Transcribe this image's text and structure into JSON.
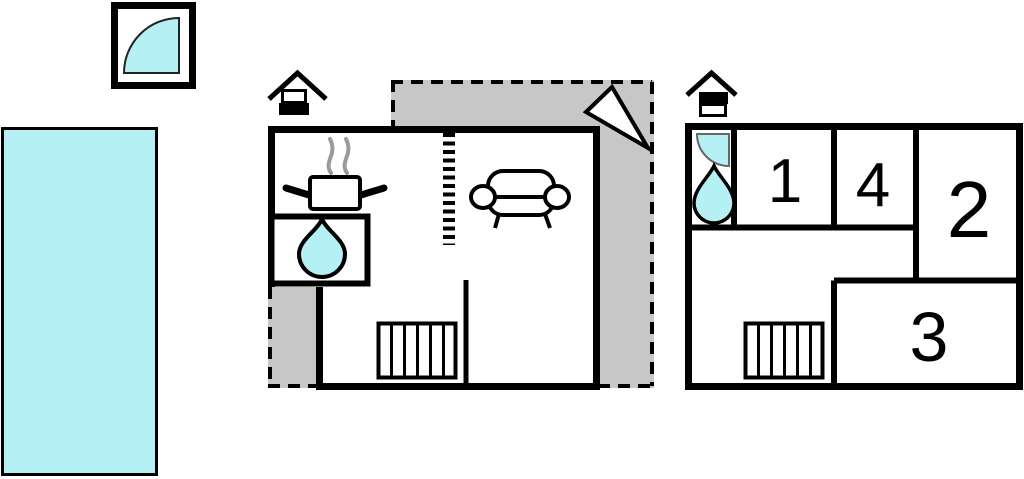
{
  "colors": {
    "water": "#b5f1f4",
    "terrace": "#c7c7c7",
    "wall": "#000000",
    "steam": "#9a9a9a",
    "background": "#ffffff"
  },
  "icons": {
    "spa": "quarter-circle-spa-icon",
    "chimney": "chimney-icon",
    "stove": "stove-pot-with-steam-icon",
    "water_drop": "water-drop-icon",
    "shower": "shower-quarter-icon",
    "sofa": "sofa-icon",
    "stairs": "stairs-icon",
    "ladder": "dashed-ladder-icon",
    "north_arrow": "north-arrow-icon"
  },
  "first_floor": {
    "room_numbers": {
      "r1": "1",
      "r2": "2",
      "r3": "3",
      "r4": "4"
    }
  }
}
